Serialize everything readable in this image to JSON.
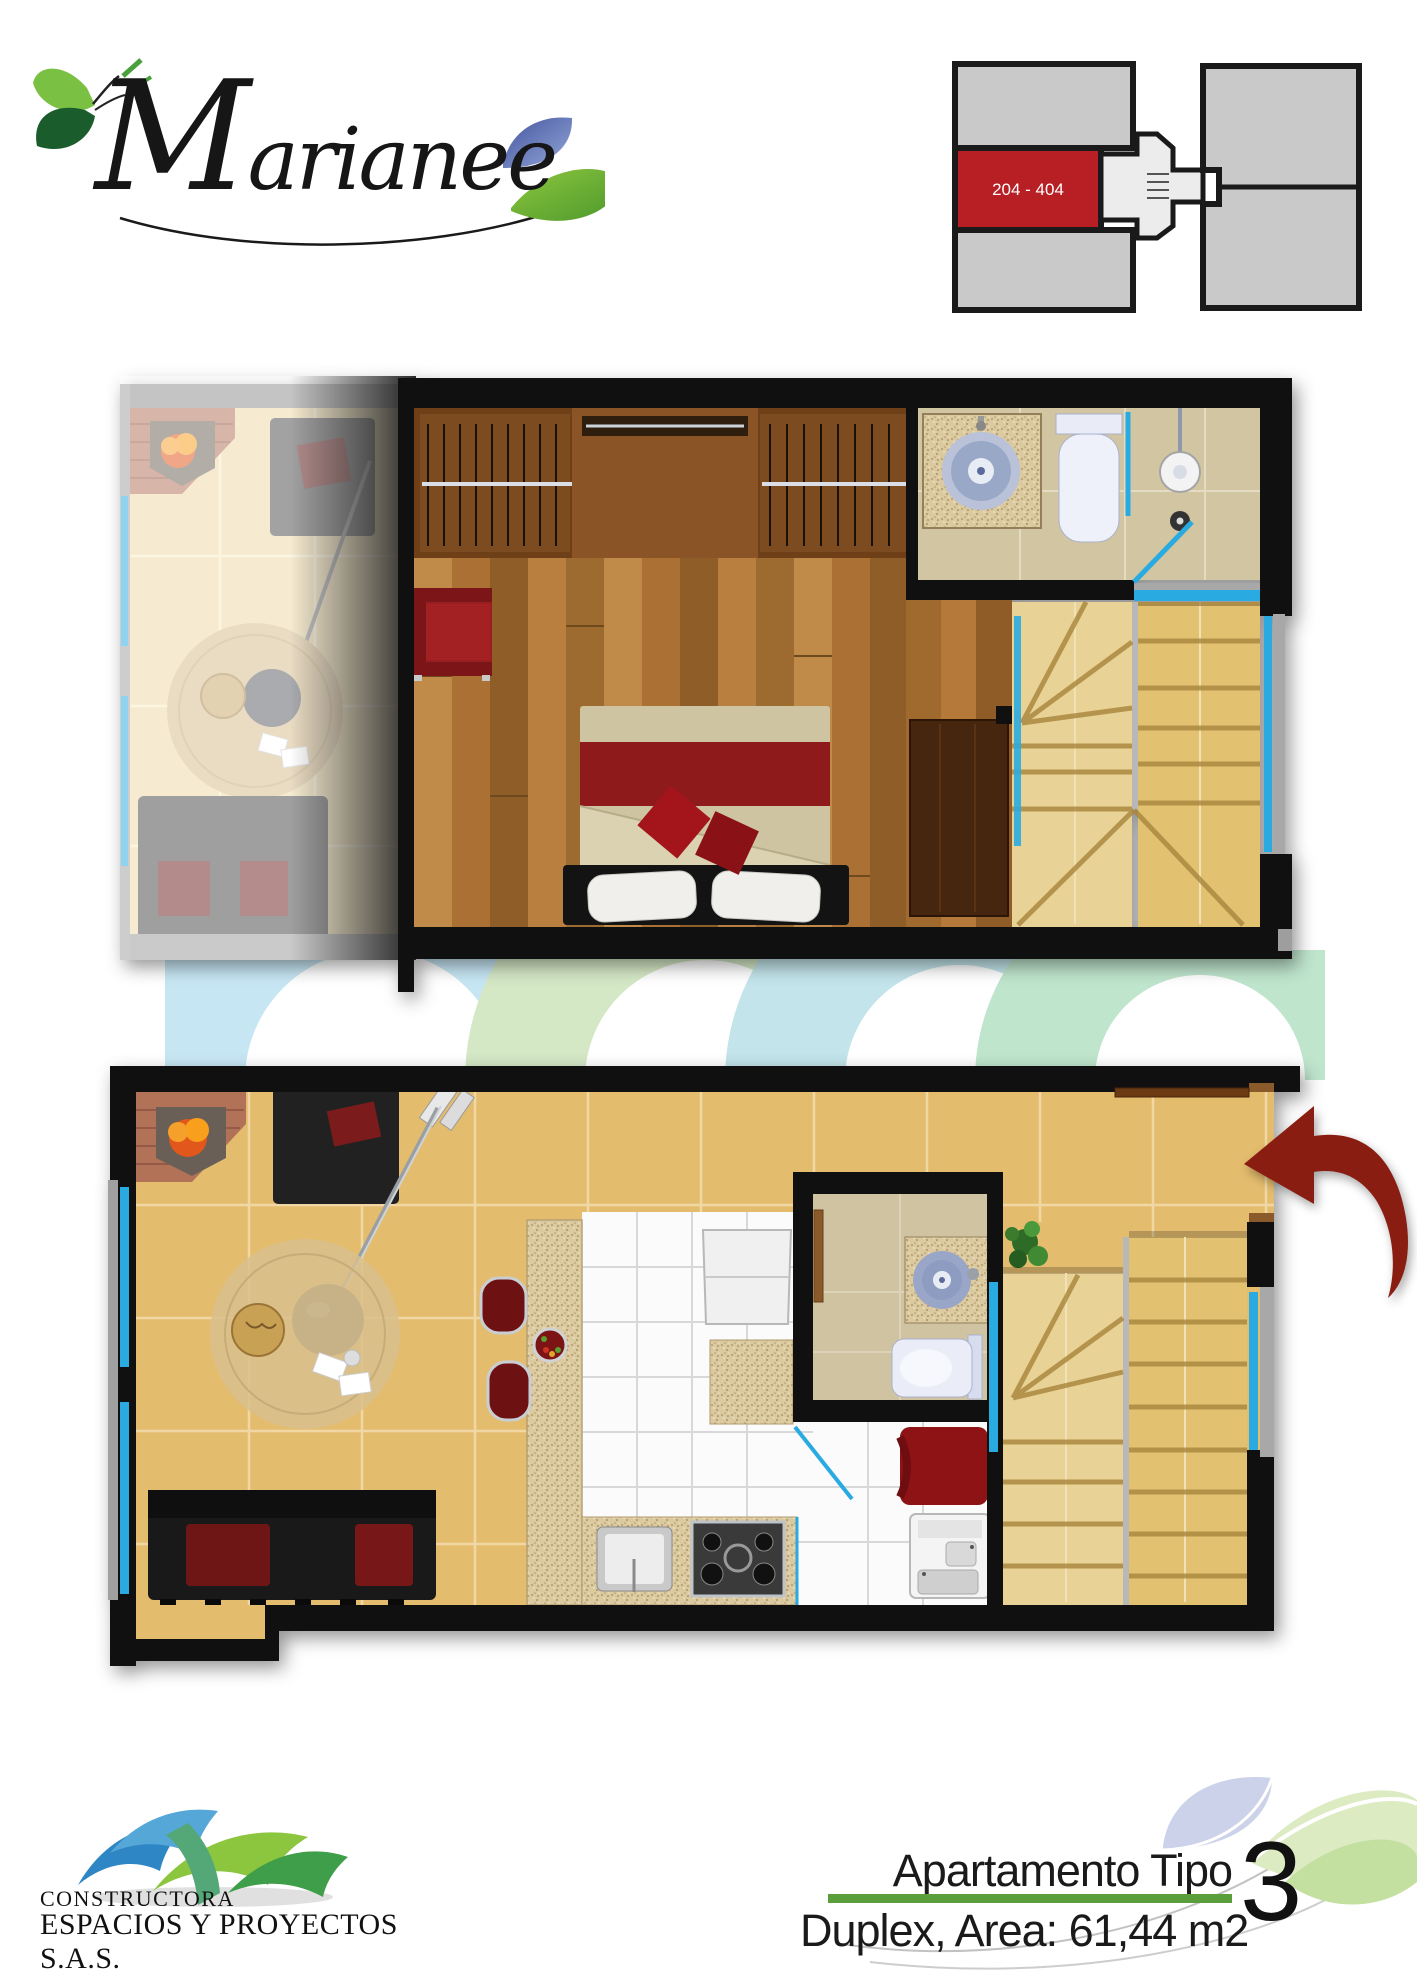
{
  "brand": {
    "name": "Marianee"
  },
  "key_plan": {
    "unit_label": "204 - 404"
  },
  "footer": {
    "company_line1": "CONSTRUCTORA",
    "company_line2": "ESPACIOS Y PROYECTOS S.A.S.",
    "apartment_line1": "Apartamento Tipo",
    "apartment_line2": "Duplex, Area: 61,44 m2",
    "apartment_number": "3"
  },
  "palette": {
    "wall_black": "#101010",
    "tile_tan": "#e4bc6e",
    "wood_brown": "#b0773a",
    "stair_gold": "#e2c271",
    "glass_blue": "#29abe2",
    "furniture_red": "#9a1d1f",
    "arrow_red": "#8a1d12",
    "keyplan_red": "#b71f24",
    "keyplan_gray": "#c9c9c9",
    "rule_green": "#5b9e3c",
    "logo_green": "#7ac143",
    "swoosh_blue": "#2e86c4",
    "swoosh_green": "#8cc63f"
  }
}
